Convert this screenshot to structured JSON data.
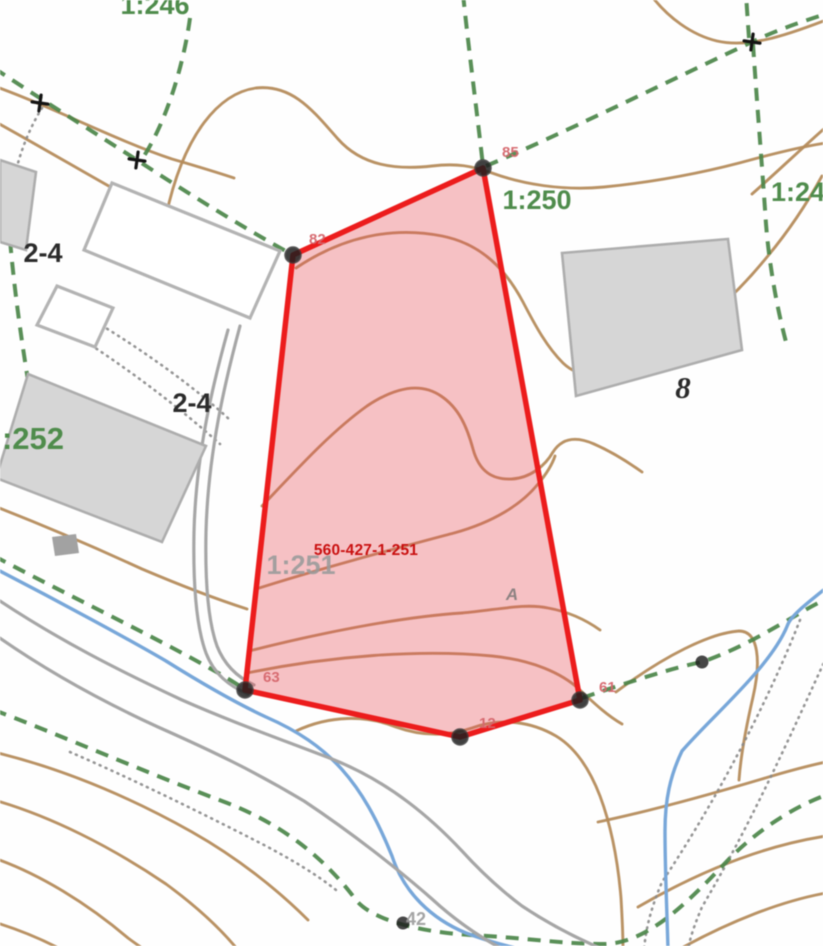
{
  "colors": {
    "contour": "#b58c5c",
    "boundary_green": "#4b8549",
    "water_blue": "#78a7d9",
    "road_gray": "#a6a6a6",
    "dots_gray": "#8a8a8a",
    "building_fill": "#d6d6d6",
    "building_stroke": "#adadad",
    "parcel_stroke": "#ec1c1c",
    "parcel_fill": "rgba(231,76,84,0.34)",
    "label_green": "#4f8c4c",
    "label_gray": "#9b9b9b",
    "label_dark": "#2b2b2b",
    "vertex_label": "#d5666c",
    "parcel_label": "#c90f0f",
    "marker_dark": "#1f1f1f"
  },
  "parcel": {
    "id": "560-427-1-251",
    "label_x": 366,
    "label_y": 555,
    "vertices": [
      {
        "label": "85",
        "x": 483,
        "y": 168,
        "label_x": 502,
        "label_y": 157
      },
      {
        "label": "82",
        "x": 293,
        "y": 255,
        "label_x": 309,
        "label_y": 244
      },
      {
        "label": "63",
        "x": 245,
        "y": 690,
        "label_x": 263,
        "label_y": 682
      },
      {
        "label": "12",
        "x": 460,
        "y": 737,
        "label_x": 479,
        "label_y": 728
      },
      {
        "label": "61",
        "x": 580,
        "y": 700,
        "label_x": 599,
        "label_y": 692
      }
    ]
  },
  "map": {
    "labels": [
      {
        "t": "1:246",
        "x": 155,
        "y": 14,
        "cls": "lbl-green"
      },
      {
        "t": "1:250",
        "x": 537,
        "y": 209,
        "cls": "lbl-green"
      },
      {
        "t": "1:24",
        "x": 798,
        "y": 201,
        "cls": "lbl-green"
      },
      {
        "t": ":252",
        "x": 33,
        "y": 449,
        "cls": "lbl-green lbl-xl"
      },
      {
        "t": "1:251",
        "x": 301,
        "y": 574,
        "cls": "lbl-gray lbl-xl"
      },
      {
        "t": "2-4",
        "x": 43,
        "y": 262,
        "cls": "lbl-dark"
      },
      {
        "t": "2-4",
        "x": 192,
        "y": 412,
        "cls": "lbl-dark"
      },
      {
        "t": "8",
        "x": 683,
        "y": 398,
        "cls": "lbl-dark lbl-it"
      },
      {
        "t": "42",
        "x": 416,
        "y": 925,
        "cls": "lbl-gray lbl-sm"
      },
      {
        "t": "A",
        "x": 512,
        "y": 600,
        "cls": "lbl-a"
      }
    ],
    "markers": {
      "crosses": [
        {
          "x": 40,
          "y": 103
        },
        {
          "x": 137,
          "y": 160
        },
        {
          "x": 752,
          "y": 42
        }
      ],
      "dots": [
        {
          "x": 702,
          "y": 662
        },
        {
          "x": 403,
          "y": 923
        }
      ]
    }
  }
}
